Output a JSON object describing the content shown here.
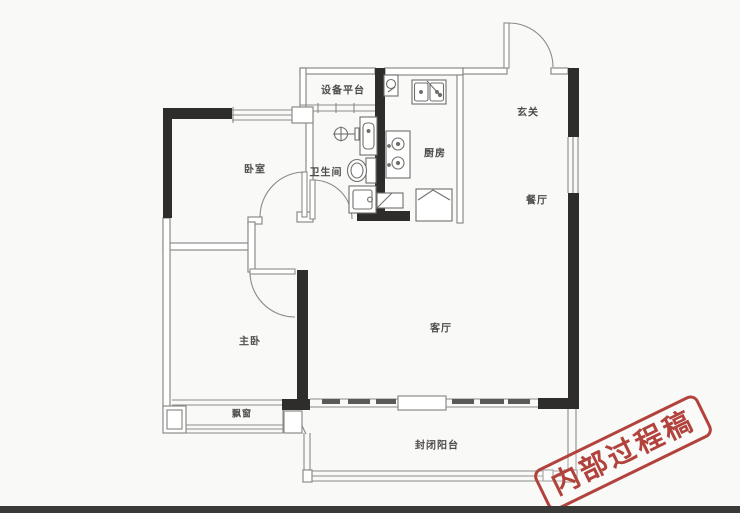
{
  "floor_plan": {
    "rooms": [
      {
        "id": "bedroom",
        "label": "卧室"
      },
      {
        "id": "equipment-platform",
        "label": "设备平台"
      },
      {
        "id": "bathroom",
        "label": "卫生间"
      },
      {
        "id": "kitchen",
        "label": "厨房"
      },
      {
        "id": "entry-hall",
        "label": "玄关"
      },
      {
        "id": "dining-room",
        "label": "餐厅"
      },
      {
        "id": "master-bedroom",
        "label": "主卧"
      },
      {
        "id": "living-room",
        "label": "客厅"
      },
      {
        "id": "bay-window",
        "label": "飘窗"
      },
      {
        "id": "enclosed-balcony",
        "label": "封闭阳台"
      }
    ],
    "watermark": {
      "text": "内部过程稿",
      "color": "#b2423c",
      "rotation_deg": -26
    },
    "fixtures": [
      "entry-door",
      "bedroom-door",
      "bathroom-door",
      "master-bedroom-door",
      "double-sink",
      "gas-stove",
      "refrigerator",
      "pipe-shaft",
      "shower-head",
      "vanity-basin",
      "toilet",
      "shower-base",
      "sliding-balcony-door",
      "windows"
    ],
    "colors": {
      "wall_black": "#2e2d2b",
      "wall_thin": "#8b8b88",
      "label_text": "#4d4c4a",
      "background": "#f9f9f7",
      "stamp_red": "#b2423c"
    }
  }
}
